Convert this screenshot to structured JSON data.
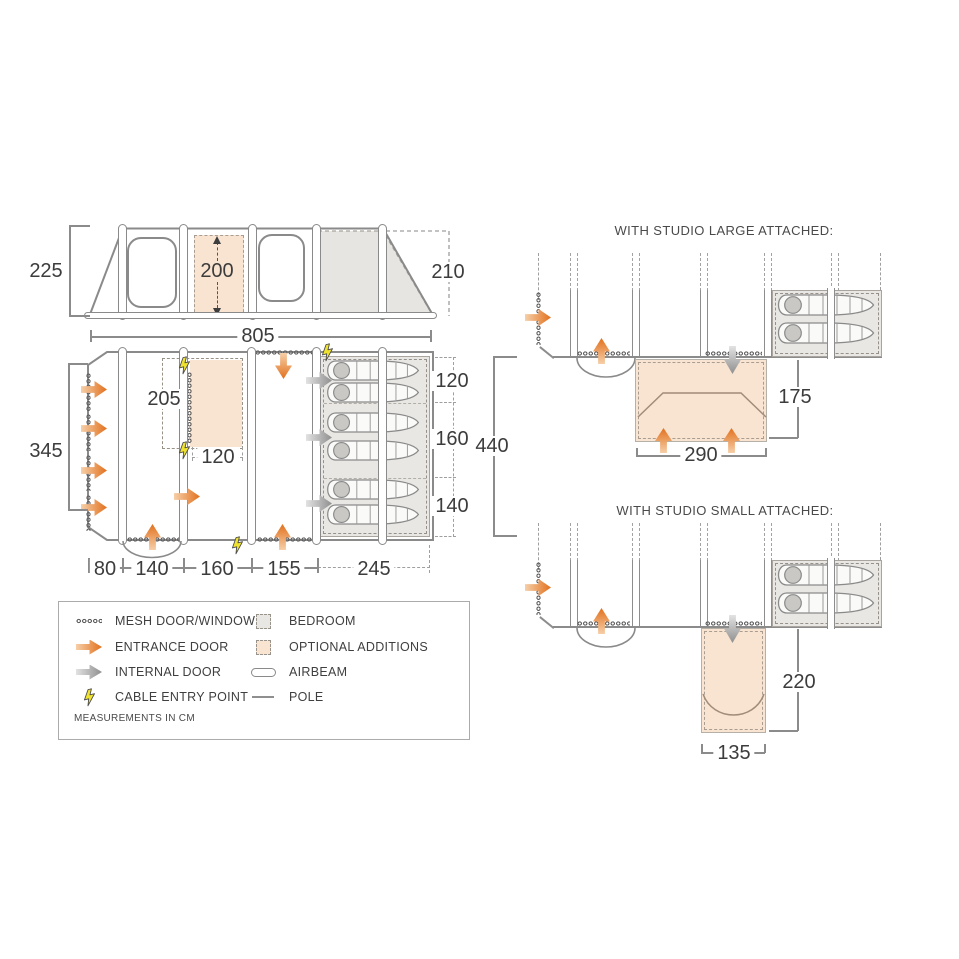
{
  "elevation": {
    "height_left": "225",
    "door_height": "200",
    "height_right": "210",
    "width_total": "805"
  },
  "floorplan": {
    "side_length": "345",
    "optional_room": {
      "height": "205",
      "width": "120"
    },
    "bedroom": {
      "top": "120",
      "middle": "160",
      "bottom": "140",
      "depth_total": "440"
    },
    "bottom_segments": [
      "80",
      "140",
      "160",
      "155",
      "245"
    ]
  },
  "studio_large": {
    "title": "WITH STUDIO LARGE ATTACHED:",
    "depth": "175",
    "width": "290"
  },
  "studio_small": {
    "title": "WITH STUDIO SMALL ATTACHED:",
    "depth": "220",
    "width": "135"
  },
  "legend": {
    "left": [
      {
        "icon": "mesh-swatch-icon",
        "label": "MESH DOOR/WINDOW"
      },
      {
        "icon": "entrance-arrow-icon",
        "label": "ENTRANCE DOOR"
      },
      {
        "icon": "internal-arrow-icon",
        "label": "INTERNAL DOOR"
      },
      {
        "icon": "cable-bolt-icon",
        "label": "CABLE ENTRY POINT"
      }
    ],
    "right": [
      {
        "icon": "bedroom-swatch-icon",
        "label": "BEDROOM"
      },
      {
        "icon": "optional-swatch-icon",
        "label": "OPTIONAL ADDITIONS"
      },
      {
        "icon": "airbeam-icon",
        "label": "AIRBEAM"
      },
      {
        "icon": "pole-icon",
        "label": "POLE"
      }
    ],
    "note": "MEASUREMENTS IN CM"
  },
  "colors": {
    "accent_orange": "#e2701d",
    "optional_fill": "#f9e3d1",
    "bedroom_fill": "#e8e7e3",
    "line_gray": "#8b8b8b",
    "text_ink": "#3c3c3c",
    "bolt_yellow": "#efe32f"
  }
}
